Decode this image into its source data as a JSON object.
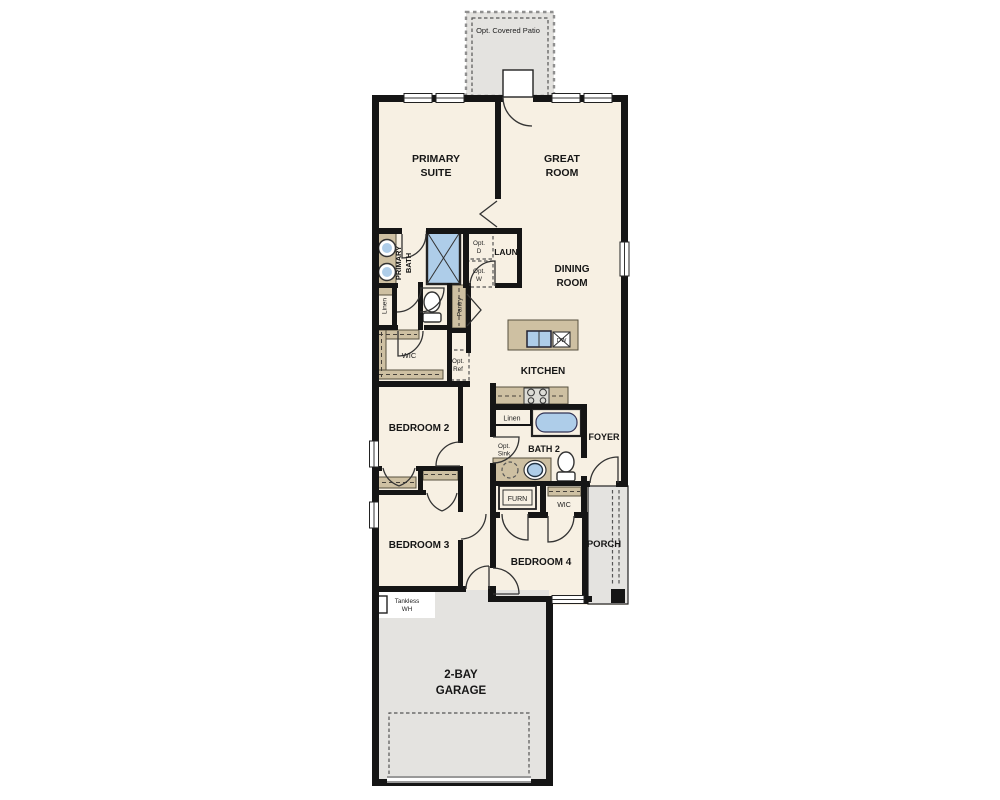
{
  "meta": {
    "type": "residential-floor-plan",
    "width": 1000,
    "height": 800
  },
  "colors": {
    "background": "#ffffff",
    "floor": "#f7f0e3",
    "wall": "#151515",
    "concrete": "#e4e3e0",
    "cabinet": "#cec0a2",
    "fixture": "#aecde9"
  },
  "rooms": {
    "patio": "Opt. Covered Patio",
    "primary_suite_l1": "PRIMARY",
    "primary_suite_l2": "SUITE",
    "great_room_l1": "GREAT",
    "great_room_l2": "ROOM",
    "primary_bath_l1": "PRIMARY",
    "primary_bath_l2": "BATH",
    "laundry": "LAUN",
    "dining_l1": "DINING",
    "dining_l2": "ROOM",
    "kitchen": "KITCHEN",
    "primary_wic": "WIC",
    "bedroom2": "BEDROOM 2",
    "bedroom3": "BEDROOM 3",
    "bedroom4": "BEDROOM 4",
    "bath2": "BATH 2",
    "foyer": "FOYER",
    "porch": "PORCH",
    "bed4_wic": "WIC",
    "garage_l1": "2-BAY",
    "garage_l2": "GARAGE"
  },
  "features": {
    "linen_primary": "Linen",
    "pantry": "Pantry",
    "opt_dryer_l1": "Opt.",
    "opt_dryer_l2": "D",
    "opt_washer_l1": "Opt.",
    "opt_washer_l2": "W",
    "opt_ref_l1": "Opt.",
    "opt_ref_l2": "Ref",
    "linen_bath2": "Linen",
    "opt_sink_l1": "Opt.",
    "opt_sink_l2": "Sink",
    "furnace": "FURN",
    "dishwasher": "DW",
    "tankless_l1": "Tankless",
    "tankless_l2": "WH"
  }
}
